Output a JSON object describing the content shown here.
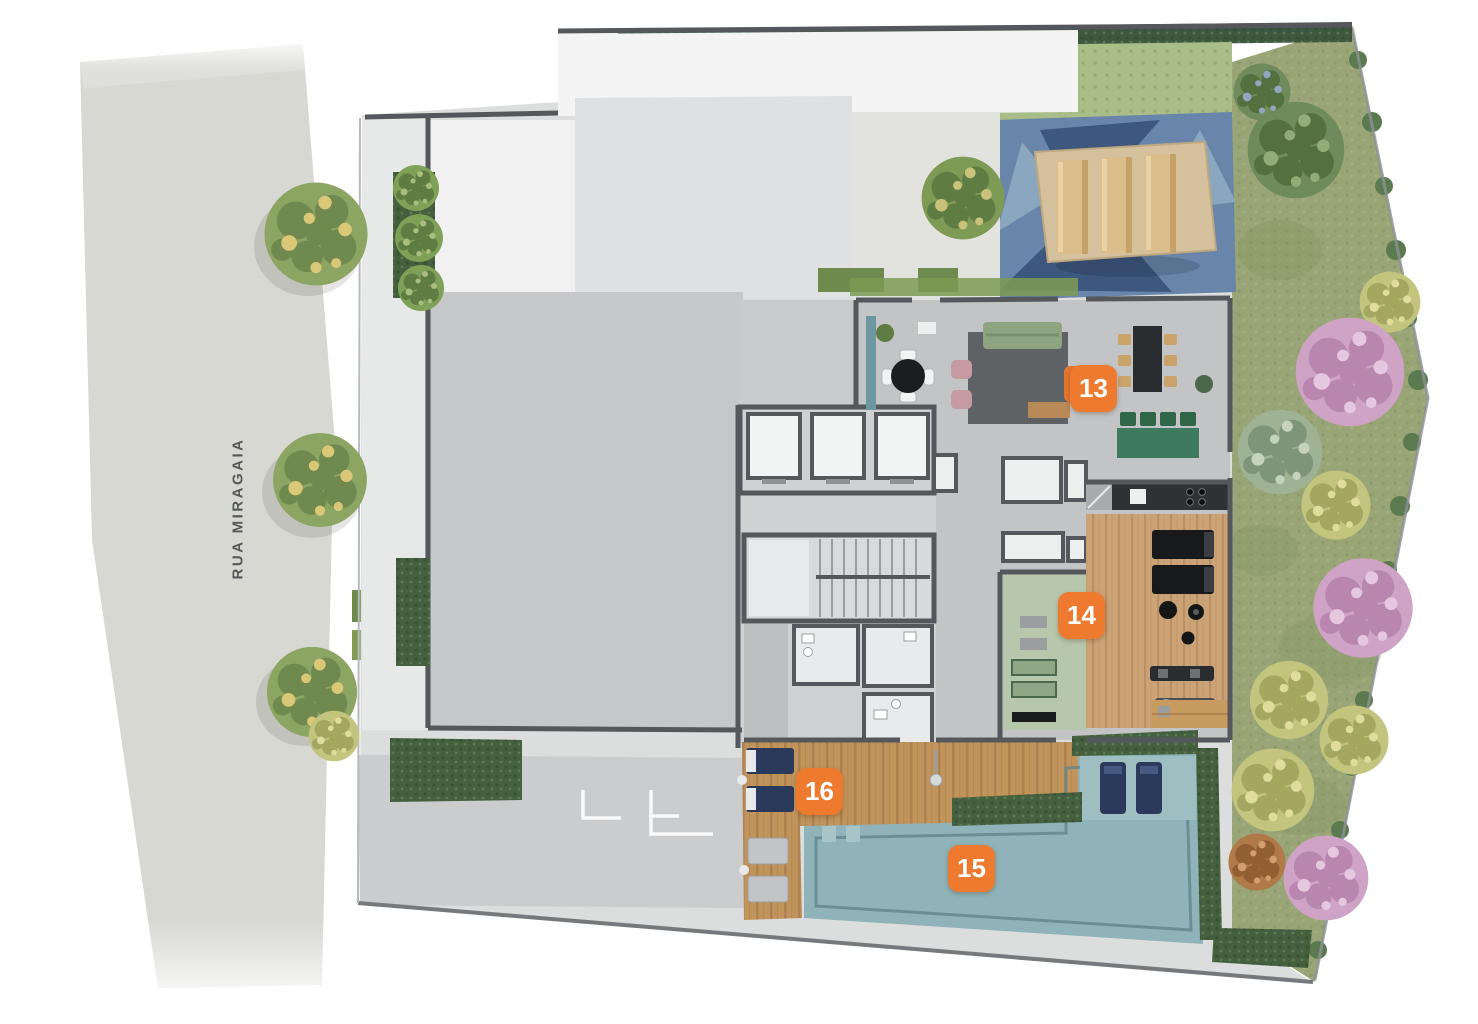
{
  "plan": {
    "street": {
      "label": "RUA MIRAGAIA"
    },
    "markers": [
      {
        "label": "13"
      },
      {
        "label": "14"
      },
      {
        "label": "15"
      },
      {
        "label": "16"
      }
    ],
    "colors": {
      "marker_orange": "#ED7A2E",
      "pool_teal": "#8FB3B8",
      "pool_lounger_navy": "#2B3A5C",
      "deck_wood": "#C1945C",
      "gym_wood": "#CBA377",
      "yoga_green": "#B7C7AC",
      "garden_olive": "#99A577",
      "hedge_green": "#44603F",
      "flower_pink": "#CFA3C6",
      "playground_blue": "#6985A9",
      "wall_gray": "#54585C",
      "street_gray": "#D7D8D2",
      "slab_gray": "#C5C7C9"
    }
  }
}
